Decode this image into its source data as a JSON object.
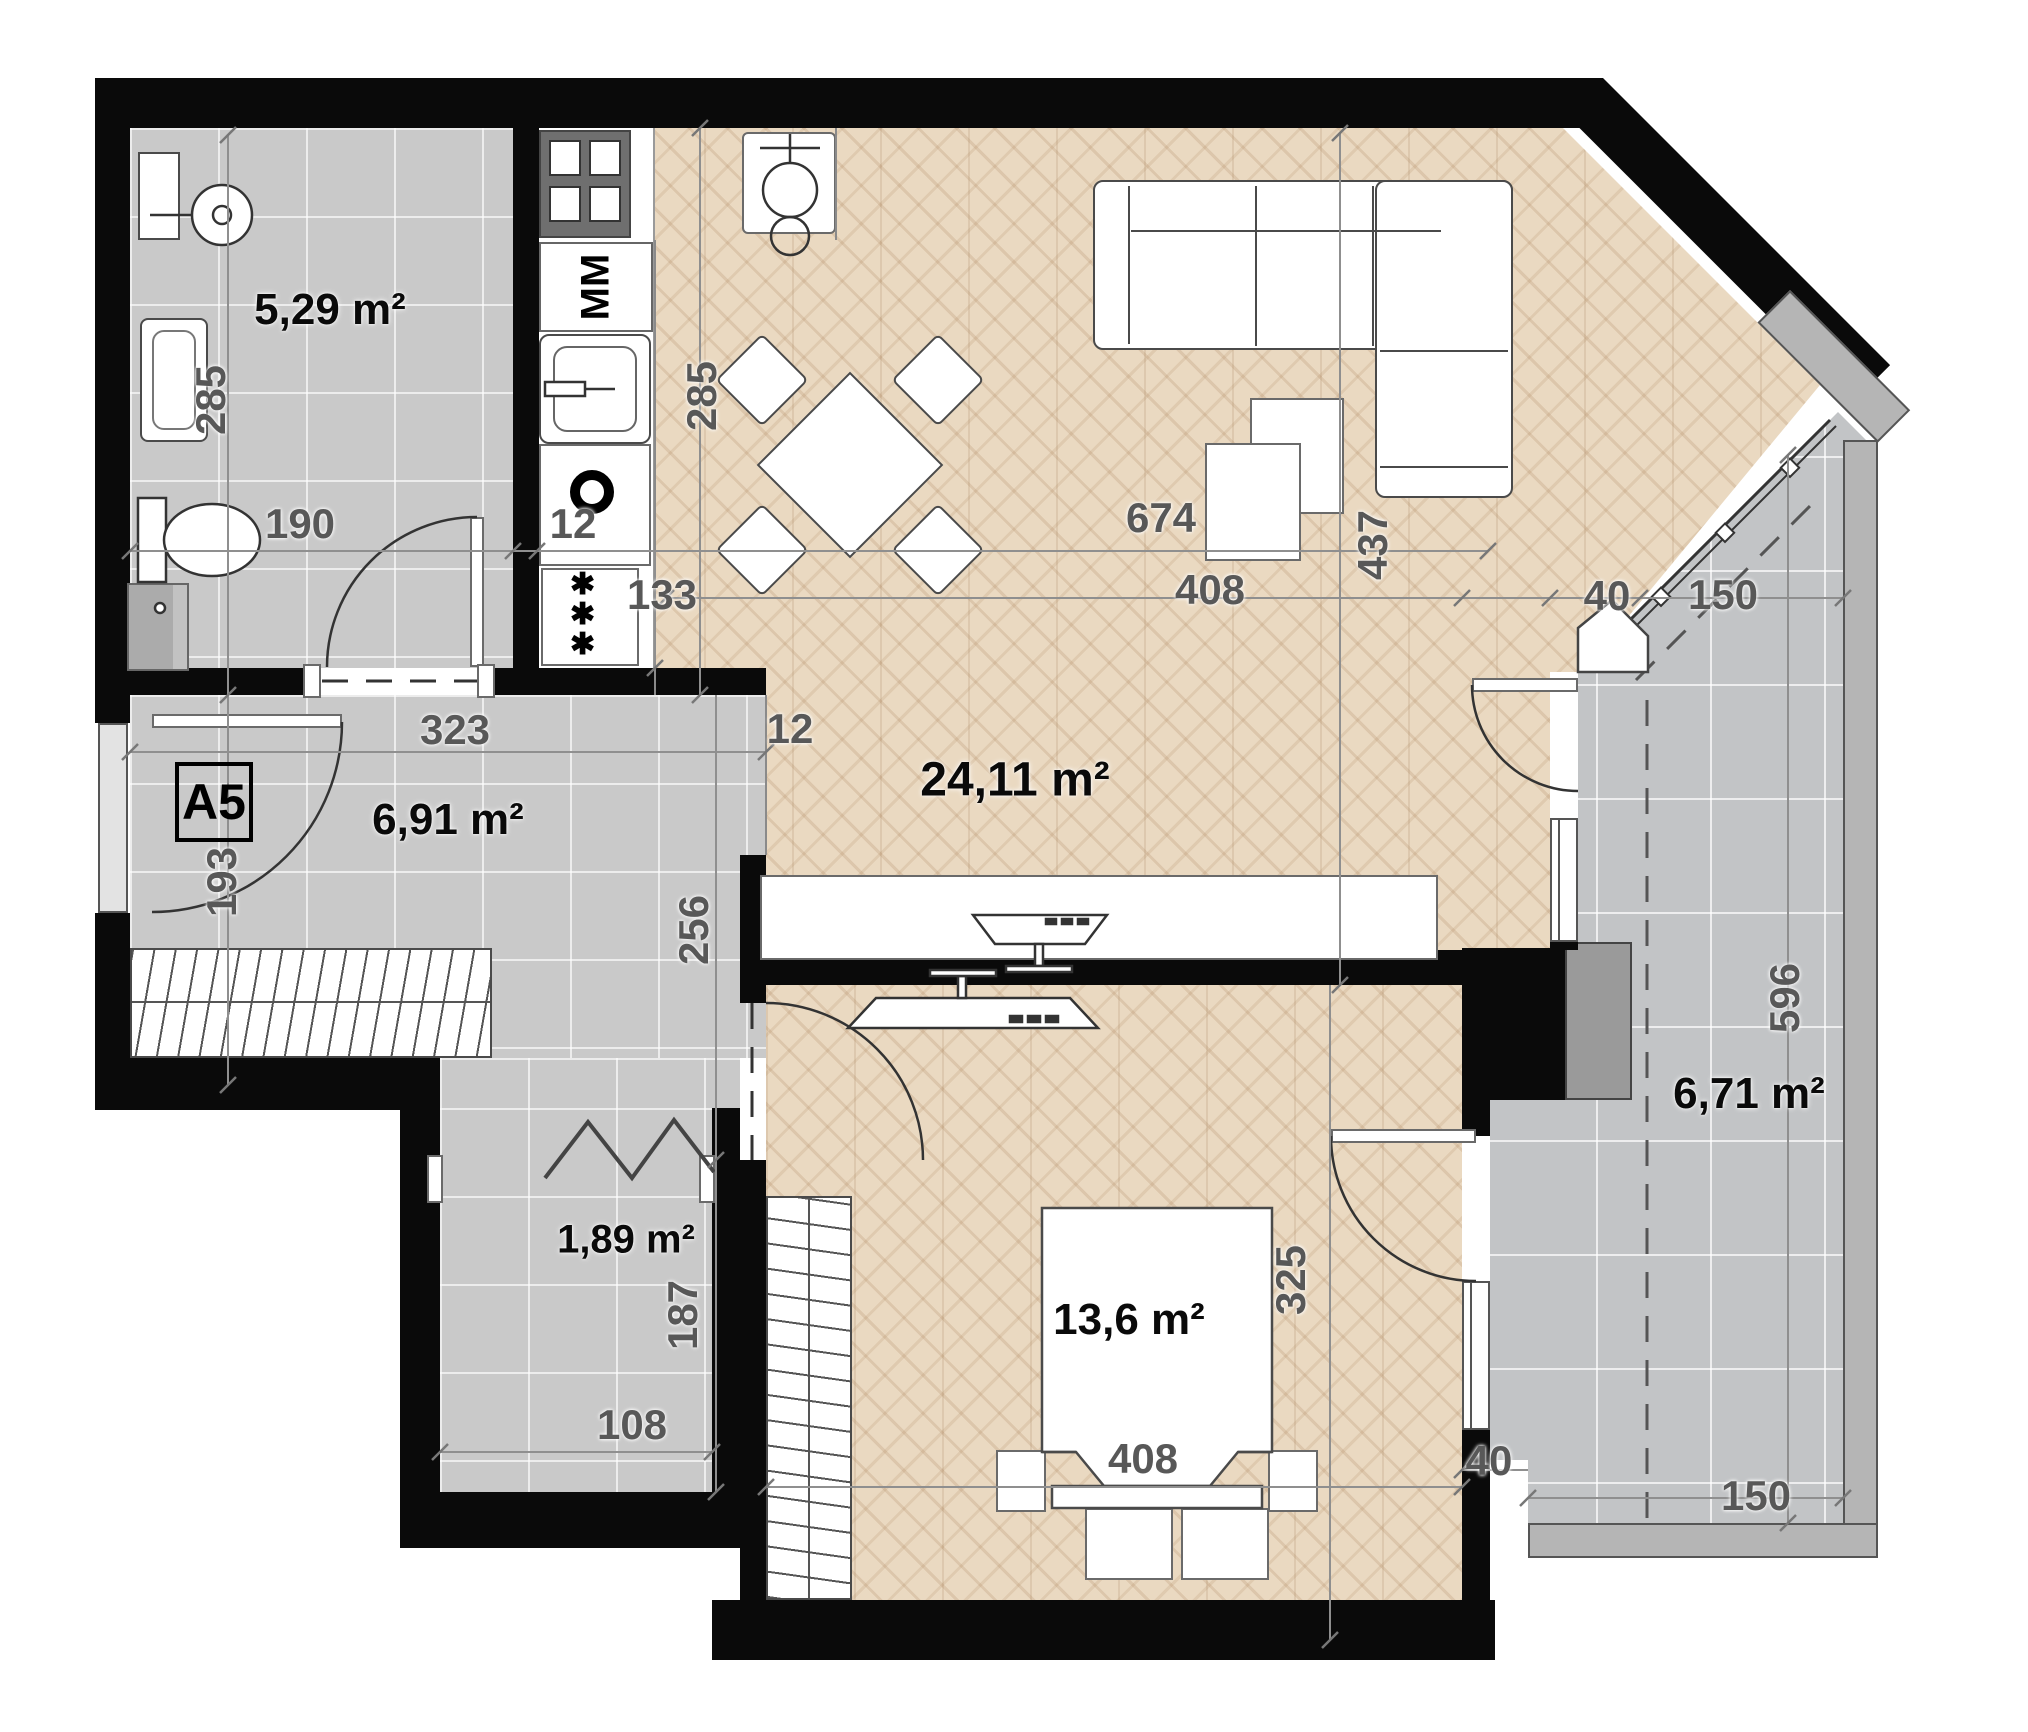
{
  "apartment_label": "A5",
  "rooms": [
    {
      "id": "bathroom",
      "area": "5,29 m²"
    },
    {
      "id": "hall",
      "area": "6,91 m²"
    },
    {
      "id": "living-kitchen",
      "area": "24,11 m²"
    },
    {
      "id": "storage",
      "area": "1,89 m²"
    },
    {
      "id": "bedroom",
      "area": "13,6 m²"
    },
    {
      "id": "balcony",
      "area": "6,71 m²"
    }
  ],
  "dimensions": {
    "bath_height": "285",
    "bath_width": "190",
    "kitchen_height": "285",
    "kitchen_wall": "12",
    "kitchen_width": "133",
    "total_width": "674",
    "living_width": "408",
    "living_height": "437",
    "corner_diag": "40",
    "window_diag": "150",
    "hall_width": "323",
    "hall_height": "193",
    "hall_right_height": "256",
    "hall_wall": "12",
    "storage_height": "187",
    "storage_width": "108",
    "bedroom_height": "325",
    "bedroom_width": "408",
    "bedroom_corner": "40",
    "balcony_width": "150",
    "balcony_height": "596"
  },
  "appliances": {
    "washing_machine": "MM",
    "radiator_symbol": "✱✱✱"
  },
  "colors": {
    "wall": "#0a0a0a",
    "tile_floor": "#c9c9c9",
    "balcony_floor": "#c2c4c6",
    "parquet": "#ead9c1",
    "kitchen_floor": "#ffffff",
    "pillar": "#9a9a9a",
    "parapet": "#b5b5b5",
    "dim_text": "#585858",
    "label_text": "#0a0a0a"
  }
}
